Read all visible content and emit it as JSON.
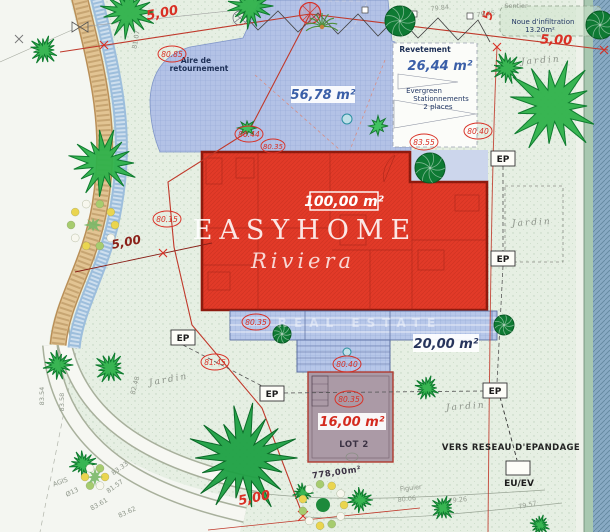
{
  "brand": {
    "name": "EASYHOME",
    "script": "Riviera",
    "estate": "REAL ESTATE"
  },
  "areas": {
    "turning": {
      "l1": "Aire de",
      "l2": "retournement",
      "surface": "56,78 m²"
    },
    "coating": {
      "name": "Revetement",
      "surface": "26,44 m²"
    },
    "parking": {
      "l1": "Evergreen",
      "l2": "Stationnements",
      "l3": "2 places"
    },
    "infiltration": {
      "l1": "Noue d'infiltration",
      "l2": "13.20m²"
    },
    "house": {
      "surface": "100,00 m²"
    },
    "terrace": {
      "surface": "20,00 m²"
    },
    "pool": {
      "surface": "16,00 m²",
      "lot": "LOT 2"
    },
    "plot": {
      "surface": "778,00m²"
    }
  },
  "dims": {
    "top_left": "5,00",
    "top_right": "5,00",
    "left": "5,00",
    "bottom": "5,00",
    "side": "5"
  },
  "levels": {
    "turning": "80.85",
    "house_a": "80.44",
    "house_b": "80.35",
    "parking": "80.40",
    "parking_b": "83.55",
    "west": "80.15",
    "terrace": "80.35",
    "steps": "80.40",
    "pool": "80.35",
    "garden": "81.45"
  },
  "spots": {
    "s1": "79.84",
    "s2": "79.75",
    "s3": "79.57",
    "s4": "80.06",
    "s5": "79.26",
    "c1": "83.54",
    "c2": "83.58",
    "c3": "82.48",
    "c4": "81.07",
    "c5": "83.33",
    "c6": "81.57",
    "c7": "83.61",
    "c8": "83.62",
    "c9": "Ø13",
    "c10": "AGIS"
  },
  "labels": {
    "jardin": "Jardin",
    "sentier": "Sentier",
    "figuier": "Figuier",
    "ep": "EP",
    "euev": "EU/EV",
    "network": "VERS RESEAU D'EPANDAGE"
  },
  "colors": {
    "house_red": "#e23a28",
    "driveway_blue": "#b3c2e6",
    "pool_gray": "#ab9aa6",
    "annotation_red": "#d93025",
    "tree_green": "#2eb14a"
  }
}
